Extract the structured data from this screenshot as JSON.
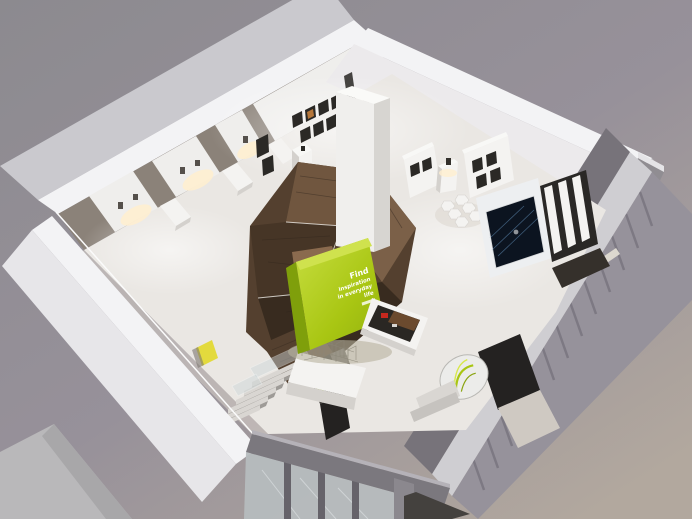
{
  "green_panel": {
    "lines": [
      "Find",
      "inspiration",
      "in everyday",
      "life"
    ]
  },
  "palette": {
    "background_top": "#8c8a8f",
    "background_bottom": "#b2a89e",
    "wall_white": "#f3f3f5",
    "wall_shadow": "#8b8279",
    "floor": "#eae7e3",
    "wood_dark": "#54402f",
    "wood_light": "#8a6a4e",
    "accent_green": "#a9c613",
    "accent_green_bright": "#c7de40",
    "screen_navy": "#0c1420",
    "red_accent": "#c4281e",
    "glass_gray": "#b6bcbe",
    "mat_charcoal": "#44413e",
    "glow_warm": "#ffefcf",
    "frame_dark": "#2b2926",
    "niche_yellow": "#e3da3d"
  }
}
